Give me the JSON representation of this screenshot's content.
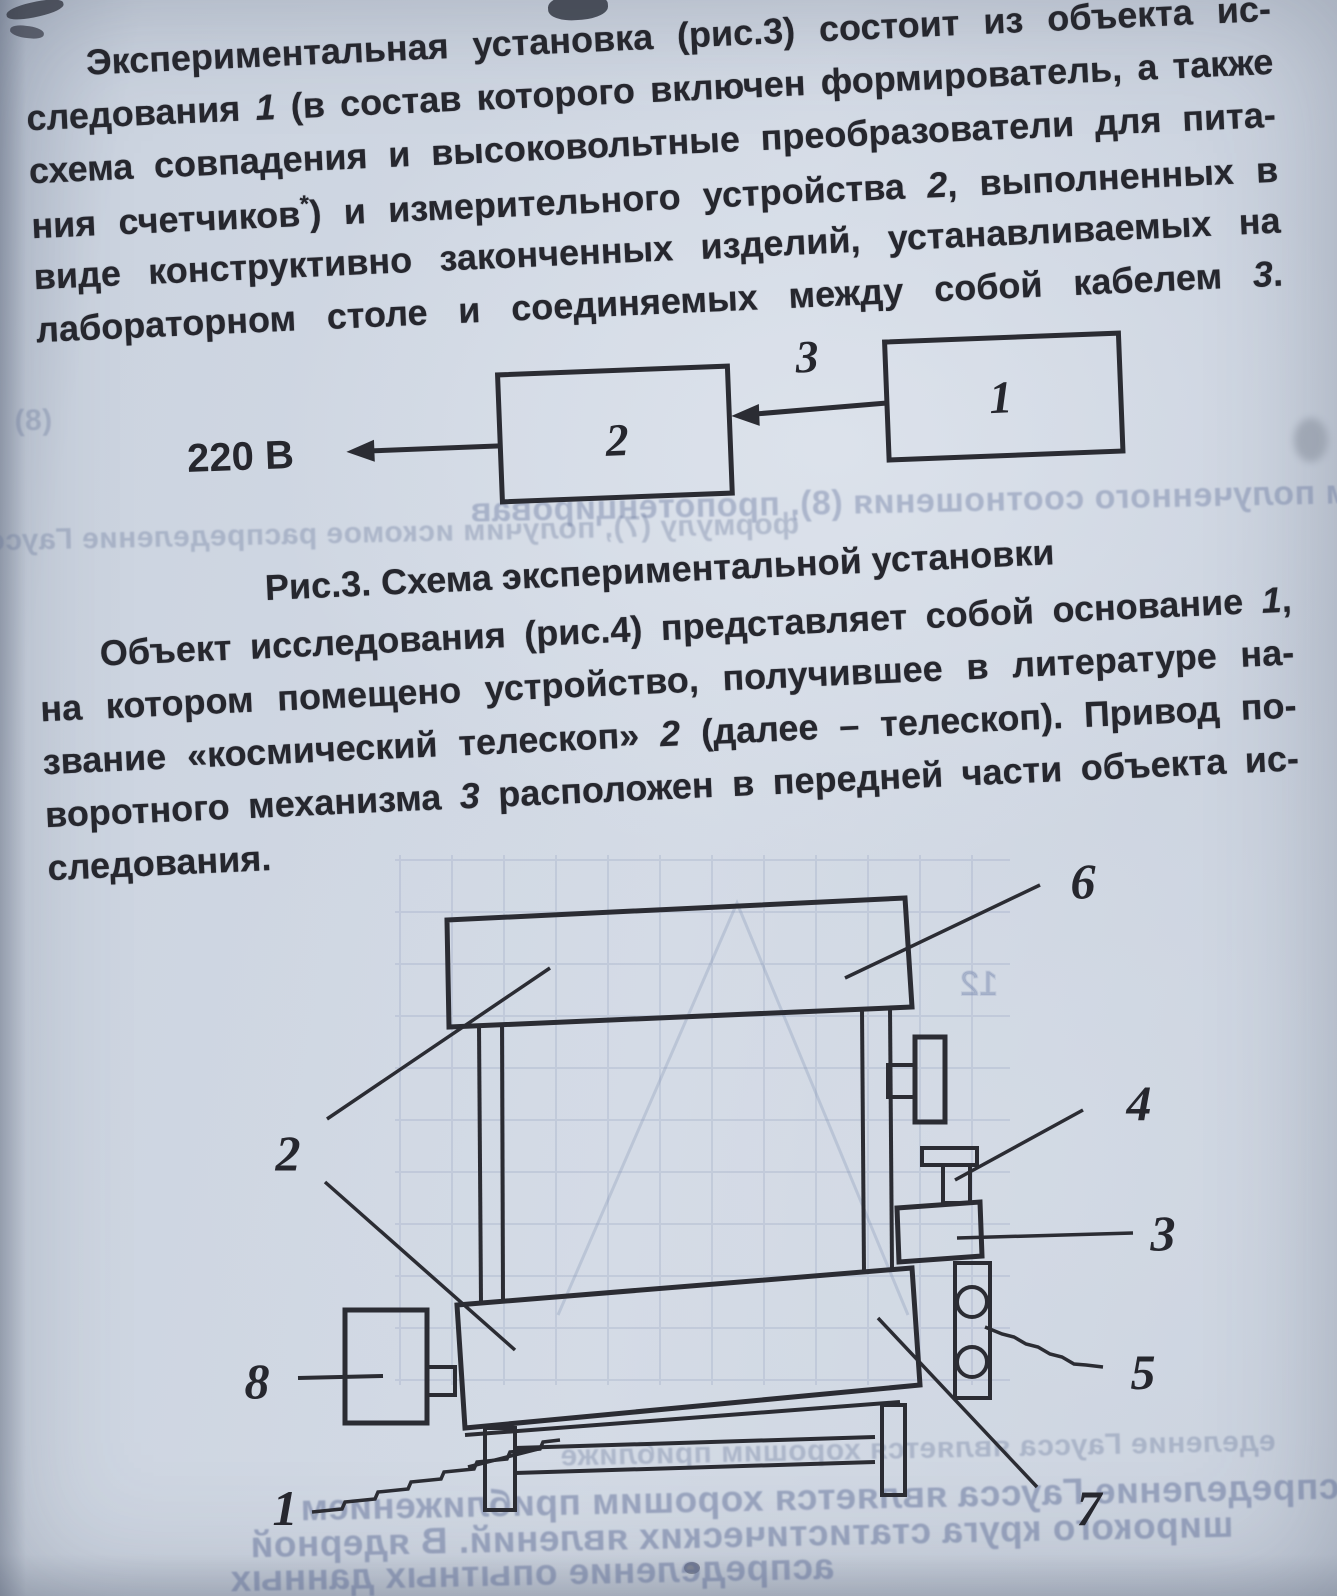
{
  "document": {
    "paragraph1": {
      "line1": "Экспериментальная установка (рис.3) состоит из объекта ис-",
      "line2a": "следования ",
      "line2_num": "1",
      "line2b": " (в состав которого включен формирователь, а также",
      "line3": "схема совпадения и высоковольтные преобразователи для пита-",
      "line4a": "ния счетчиков",
      "line4_footnote": "*",
      "line4b": ") и измерительного устройства ",
      "line4_num": "2",
      "line4c": ", выполненных в",
      "line5": "виде конструктивно законченных изделий, устанавливаемых на",
      "line6a": "лабораторном столе и соединяемых между собой кабелем ",
      "line6_num": "3",
      "line6b": "."
    },
    "paragraph2": {
      "line1a": "Объект исследования (рис.4) представляет собой основание ",
      "line1_num": "1",
      "line1b": ",",
      "line2": "на котором помещено устройство, получившее в литературе на-",
      "line3a": "звание «космический телескоп» ",
      "line3_num": "2",
      "line3b": " (далее – телескоп). Привод по-",
      "line4a": "воротного механизма ",
      "line4_num": "3",
      "line4b": " расположен в передней части объекта ис-",
      "line5": "следования."
    },
    "fig3": {
      "mains_voltage": "220 В",
      "block_measuring_device": "2",
      "block_object": "1",
      "cable_label": "3",
      "caption": "Рис.3. Схема экспериментальной установки"
    },
    "fig4": {
      "label_base": "1",
      "label_telescope": "2",
      "label_drive": "3",
      "label_adjuster": "4",
      "label_screws": "5",
      "label_plate": "6",
      "label_bottom": "7",
      "label_housing": "8",
      "bleed_digit": "12"
    },
    "bleed_through": {
      "formula_ref": "(8)",
      "mid1": "Тогда с учетом полученного соотношения (8), пропотенцировав",
      "mid2": "формулу (7), получим искомое распределение Гаусса",
      "bottom1": "еделение Гаусса является хорошим приближе",
      "bottom2": "распределение Гаусса является хорошим приближением",
      "bottom3": "широкого круга статистических явлений. В ядерной",
      "bottom4": "аспределение опытных данных"
    }
  }
}
